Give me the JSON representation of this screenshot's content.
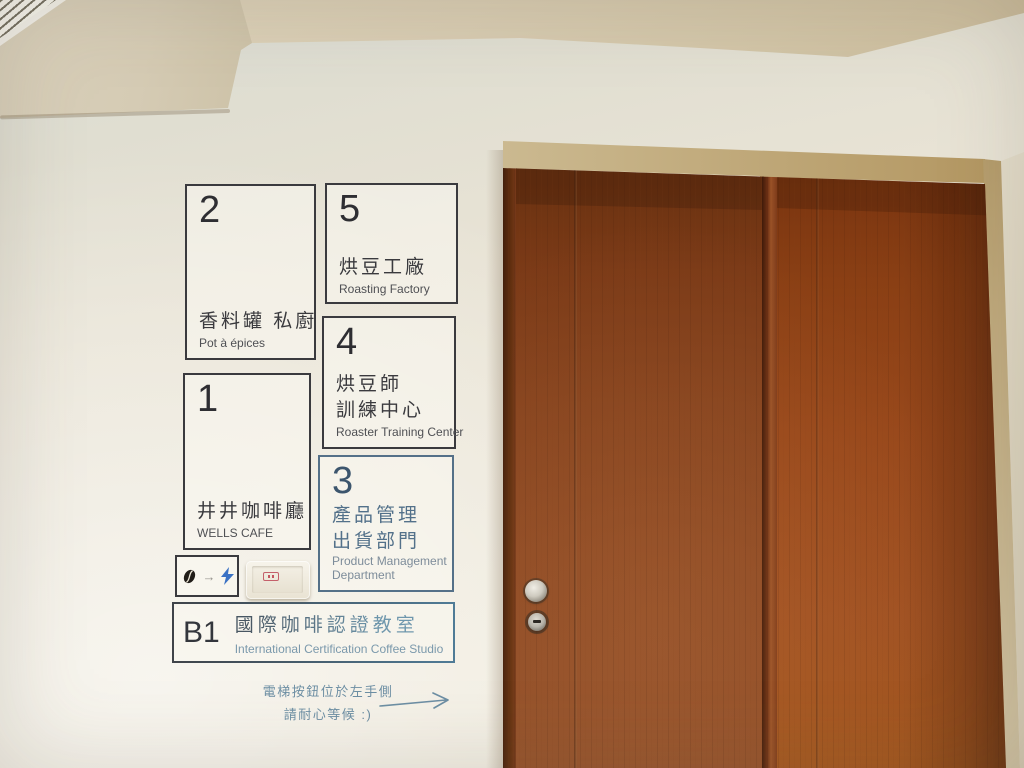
{
  "sign": {
    "box2": {
      "floor": "2",
      "zh": "香料罐 私廚",
      "en": "Pot à épices"
    },
    "box5": {
      "floor": "5",
      "zh": "烘豆工廠",
      "en": "Roasting Factory"
    },
    "box4": {
      "floor": "4",
      "zh1": "烘豆師",
      "zh2": "訓練中心",
      "en": "Roaster Training Center"
    },
    "box1": {
      "floor": "1",
      "zh": "井井咖啡廳",
      "en": "WELLS CAFE"
    },
    "box3": {
      "floor": "3",
      "zh1": "產品管理",
      "zh2": "出貨部門",
      "en1": "Product Management",
      "en2": "Department"
    },
    "boxB1": {
      "floor": "B1",
      "zh": "國際咖啡認證教室",
      "en": "International Certification Coffee Studio"
    },
    "note": {
      "line1": "電梯按鈕位於左手側",
      "line2": "請耐心等候 :)"
    },
    "bean_plate": {
      "arrow_char": "→"
    }
  },
  "colors": {
    "sign_ink": "#3a3a3e",
    "sign_blue": "#55748d",
    "note_blue": "#6d8fa4",
    "bolt_blue": "#3a72c4",
    "door_brown": "#8a4520",
    "frame_tan": "#c0a877",
    "wall_cream": "#ece7d9",
    "ceiling_beige": "#d5c9ae"
  }
}
